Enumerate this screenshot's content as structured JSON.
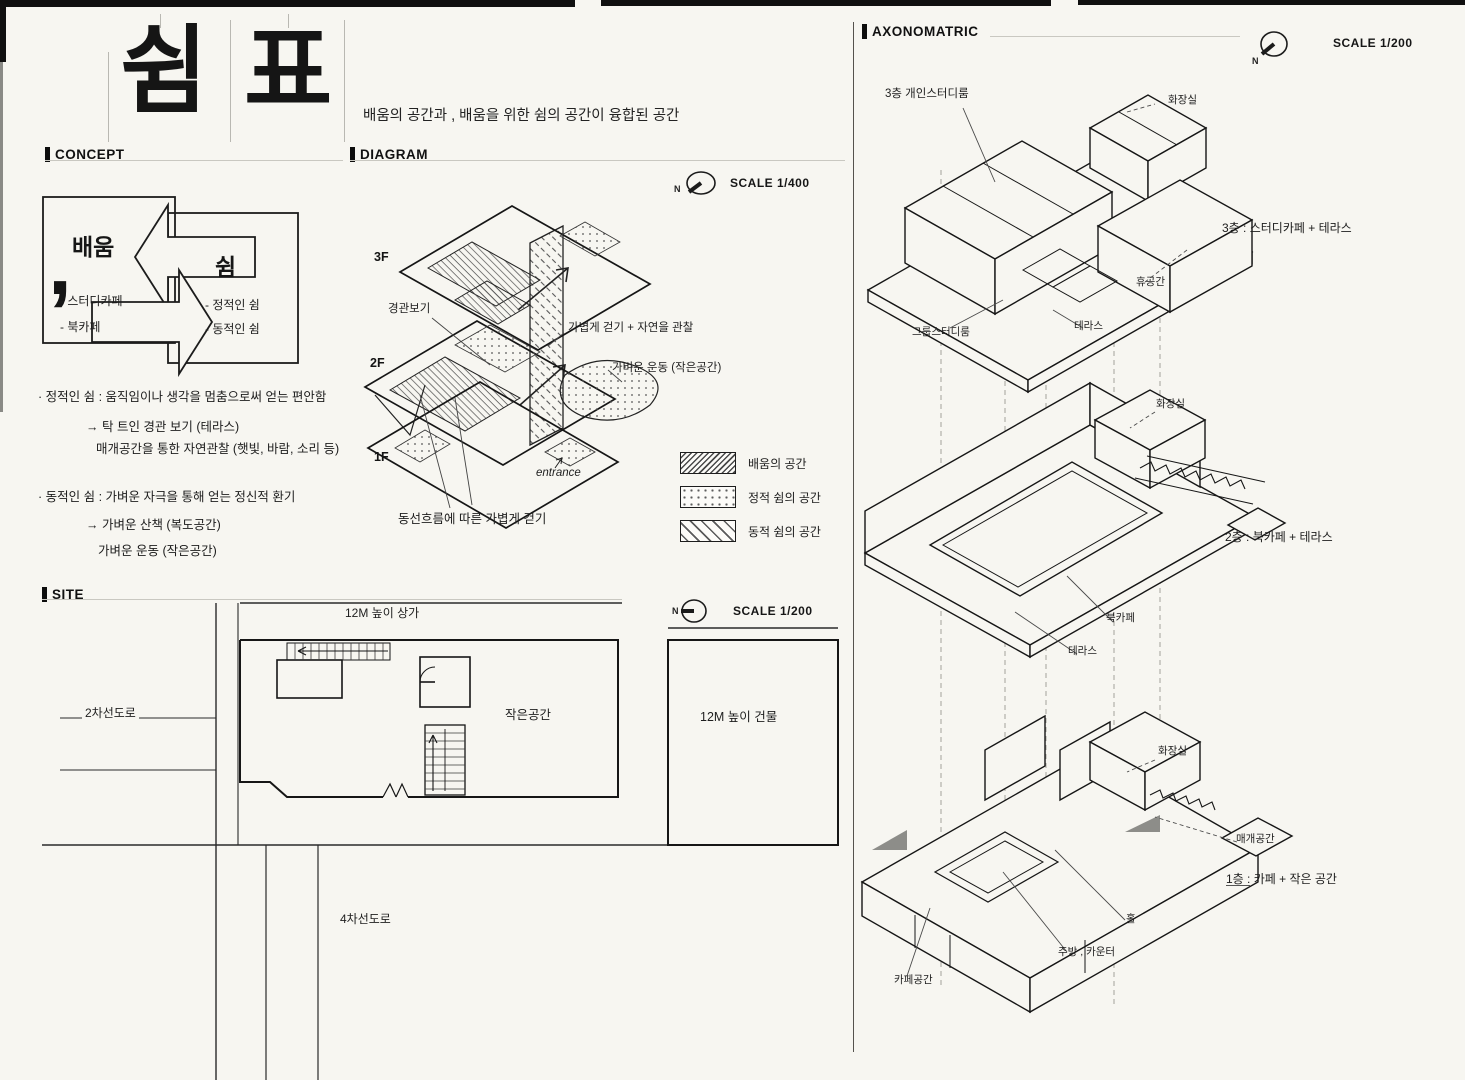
{
  "common": {
    "north": "N"
  },
  "title": {
    "comma": ",",
    "char1": "쉼",
    "char2": "표",
    "subtitle": "배움의 공간과 ,  배움을 위한 쉼의 공간이 융합된 공간"
  },
  "concept": {
    "header": "CONCEPT",
    "learn": {
      "title": "배움",
      "item1": "- 스터디카페",
      "item2": "- 북카페"
    },
    "rest": {
      "title": "쉼",
      "item1": "- 정적인 쉼",
      "item2": "- 동적인 쉼"
    },
    "notes": [
      "· 정적인 쉼 : 움직임이나 생각을 멈춤으로써 얻는 편안함",
      "→ 탁 트인 경관 보기 (테라스)",
      "매개공간을 통한 자연관찰 (햇빛, 바람, 소리 등)",
      "· 동적인 쉼 :  가벼운 자극을 통해 얻는 정신적 환기",
      "→ 가벼운 산책 (복도공간)",
      "가벼운 운동 (작은공간)"
    ]
  },
  "diagram": {
    "header": "DIAGRAM",
    "scale": "SCALE 1/400",
    "f3": "3F",
    "f2": "2F",
    "f1": "1F",
    "view": "경관보기",
    "walk": "가볍게 걷기 + 자연을 관찰",
    "exercise": "가벼운 운동 (작은공간)",
    "entrance": "entrance",
    "flow": "동선흐름에 따른 가볍게 걷기",
    "legend": [
      {
        "label": "배움의 공간"
      },
      {
        "label": "정적 쉼의 공간"
      },
      {
        "label": "동적 쉼의 공간"
      }
    ]
  },
  "site": {
    "header": "SITE",
    "scale": "SCALE 1/200",
    "shop": "12M 높이 상가",
    "road2": "2차선도로",
    "small": "작은공간",
    "building": "12M 높이 건물",
    "road4": "4차선도로"
  },
  "axon": {
    "header": "AXONOMATRIC",
    "scale": "SCALE 1/200",
    "f3": {
      "study": "3층 개인스터디룸",
      "toilet": "화장실",
      "rest": "휴공간",
      "group": "그룹스터디룸",
      "terrace": "테라스",
      "caption": "3층 : 스터디카페 + 테라스"
    },
    "f2": {
      "toilet": "화장실",
      "bookcafe": "북카페",
      "terrace": "테라스",
      "caption": "2층 : 북카페 + 테라스"
    },
    "f1": {
      "toilet": "화장실",
      "mediating": "매개공간",
      "hall": "홀",
      "kitchen": "주방 , 카운터",
      "cafe": "카페공간",
      "caption": "1층 : 카페 + 작은 공간"
    }
  }
}
